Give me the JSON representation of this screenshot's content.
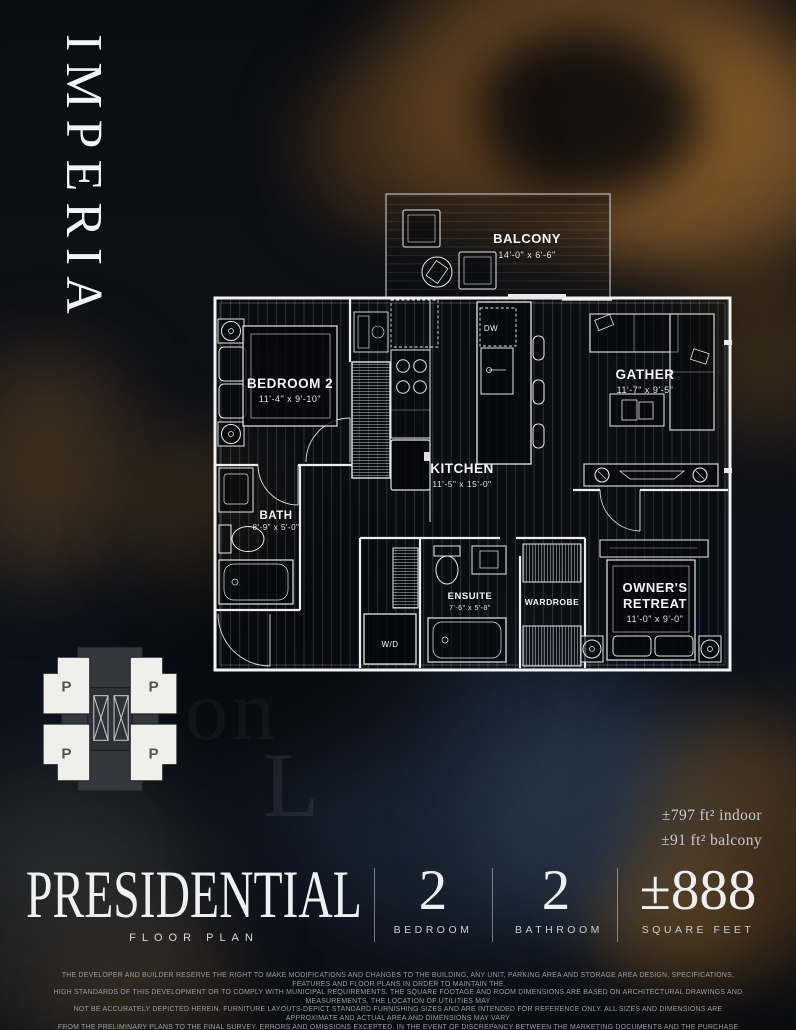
{
  "brand": {
    "name": "IMPERIA"
  },
  "colors": {
    "gold_accent": "#8a5f2c",
    "background": "#0b0e13",
    "plan_lines": "#f2f2f2",
    "title_text": "#eef0f2"
  },
  "watermark": {
    "line1": "on",
    "line2": "L"
  },
  "floorplan": {
    "rooms": {
      "balcony": {
        "name": "BALCONY",
        "dims": "14'-0\" x 6'-6\""
      },
      "bedroom2": {
        "name": "BEDROOM 2",
        "dims": "11'-4\" x 9'-10\""
      },
      "gather": {
        "name": "GATHER",
        "dims": "11'-7\" x 9'-5\""
      },
      "kitchen": {
        "name": "KITCHEN",
        "dims": "11'-5\" x 15'-0\""
      },
      "bath": {
        "name": "BATH",
        "dims": "8'-9\" x 5'-0\""
      },
      "ensuite": {
        "name": "ENSUITE",
        "dims": "7'-6\" x 5'-8\""
      },
      "wardrobe": {
        "name": "WARDROBE"
      },
      "owners_retreat": {
        "line1": "OWNER'S",
        "line2": "RETREAT",
        "dims": "11'-0\" x 9'-0\""
      }
    },
    "labels": {
      "dishwasher": "DW",
      "washer_dryer": "W/D"
    }
  },
  "keyplan": {
    "unit_label": "P"
  },
  "area": {
    "indoor": "±797 ft² indoor",
    "balcony": "±91 ft² balcony"
  },
  "title": {
    "name": "PRESIDENTIAL",
    "subtitle": "FLOOR PLAN"
  },
  "stats": [
    {
      "value": "2",
      "label": "BEDROOM"
    },
    {
      "value": "2",
      "label": "BATHROOM"
    },
    {
      "value": "±888",
      "label": "SQUARE FEET"
    }
  ],
  "disclaimer": {
    "line1": "THE DEVELOPER AND BUILDER RESERVE THE RIGHT TO MAKE MODIFICATIONS AND CHANGES TO THE BUILDING, ANY UNIT, PARKING AREA AND STORAGE AREA DESIGN, SPECIFICATIONS, FEATURES AND FLOOR PLANS IN ORDER TO MAINTAIN THE",
    "line2": "HIGH STANDARDS OF THIS DEVELOPMENT OR TO COMPLY WITH MUNICIPAL REQUIREMENTS. THE SQUARE FOOTAGE AND ROOM DIMENSIONS ARE BASED ON ARCHITECTURAL DRAWINGS AND MEASUREMENTS. THE LOCATION OF UTILITIES MAY",
    "line3": "NOT BE ACCURATELY DEPICTED HEREIN. FURNITURE LAYOUTS DEPICT STANDARD FURNISHING SIZES AND ARE INTENDED FOR REFERENCE ONLY. ALL SIZES AND DIMENSIONS ARE APPROXIMATE AND ACTUAL AREA AND DIMENSIONS MAY VARY",
    "line4": "FROM THE PRELIMINARY PLANS TO THE FINAL SURVEY. ERRORS AND OMISSIONS EXCEPTED. IN THE EVENT OF DISCREPANCY BETWEEN THE MARKETING DOCUMENTS AND THE PURCHASE CONTRACT, THE PURCHASE CONTRACT, WILL PREVAIL."
  }
}
